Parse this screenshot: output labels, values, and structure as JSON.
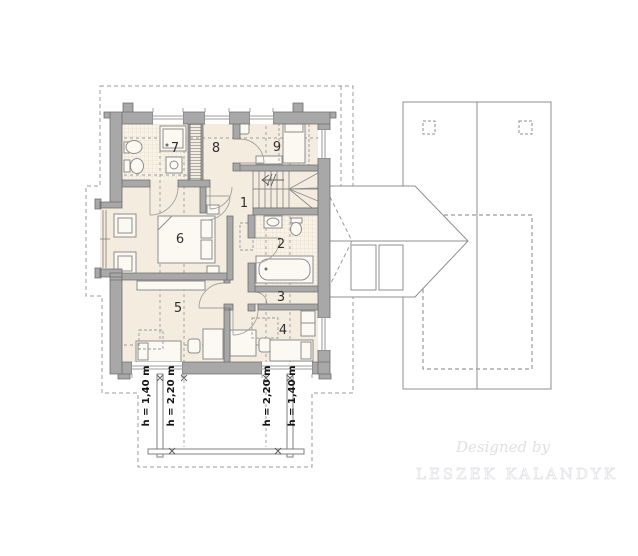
{
  "rooms": [
    {
      "number": "1"
    },
    {
      "number": "2"
    },
    {
      "number": "3"
    },
    {
      "number": "4"
    },
    {
      "number": "5"
    },
    {
      "number": "6"
    },
    {
      "number": "7"
    },
    {
      "number": "8"
    },
    {
      "number": "9"
    }
  ],
  "height_labels": [
    "h = 1,40 m",
    "h = 2,20 m",
    "h = 2,20 m",
    "h = 1,40 m"
  ],
  "watermark": {
    "line1": "Designed by",
    "line2": "LESZEK KALANDYK"
  },
  "colors": {
    "wall_fill": "#a8a8a8",
    "wall_stroke": "#6d6d6d",
    "floor": "#f4ecdf",
    "tile_floor": "#f8f2e7",
    "tile_line": "#ddd2bf",
    "furniture_line": "#8d8d8d",
    "dashed_line": "#9b9b9b",
    "roof_line": "#8f8f8f",
    "label_text": "#2f2f2f",
    "dimension_text": "#141414",
    "watermark_script": "#dfe0e4",
    "watermark_caps": "#e4e4e9"
  }
}
